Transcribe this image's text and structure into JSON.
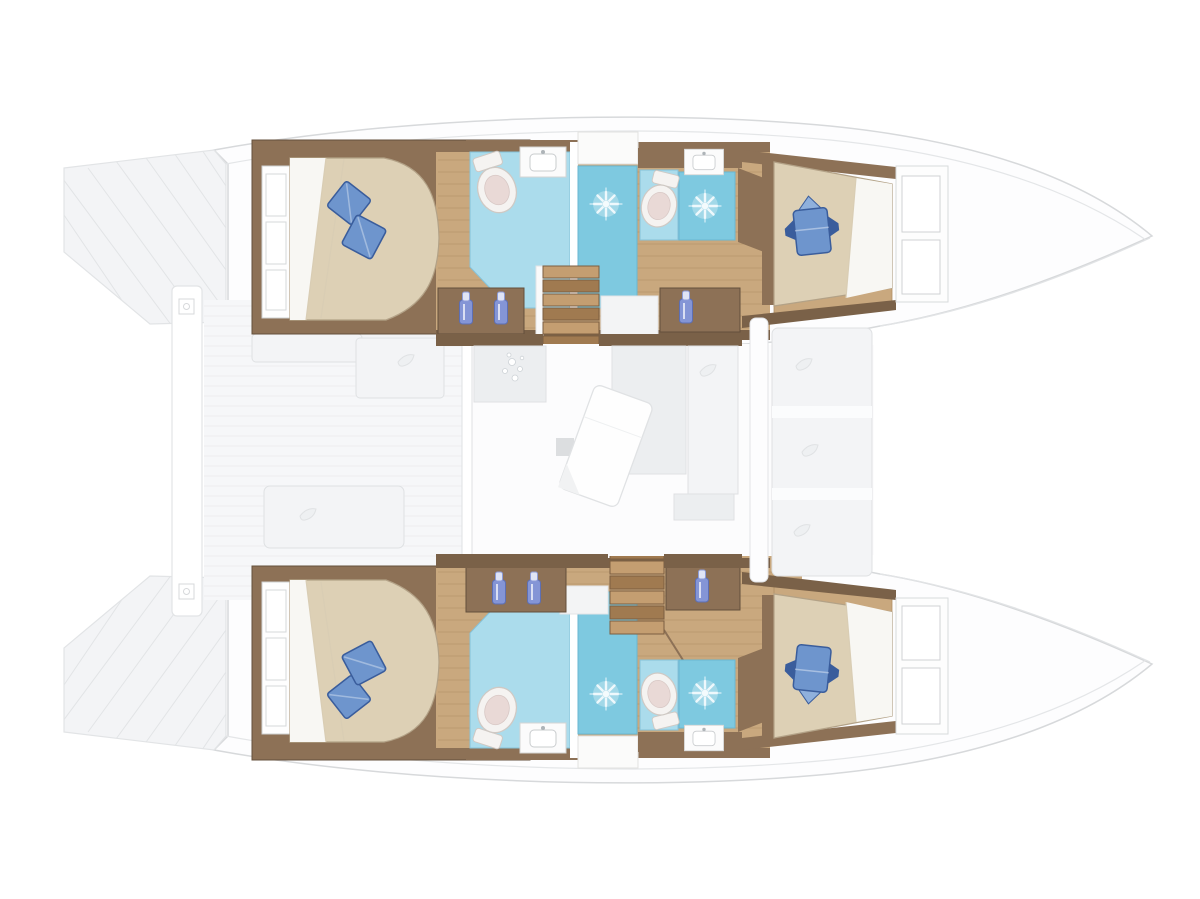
{
  "meta": {
    "description": "Top-down interior layout plan of a sailing catamaran, bows pointing right: two hulls each with an aft double cabin, forward double cabin and two bathroom/shower compartments; central bridgedeck salon with galley counter, tilted dining table and two companionway stairs; aft cockpit deck with benches at left, bow cockpit seating at right.",
    "visible_text": "none"
  },
  "palette": {
    "background": "#ffffff",
    "hull_line": "#d7d9db",
    "hull_line_soft": "#e4e6e8",
    "hull_fill": "#fdfdfe",
    "bridge_fill": "#fcfcfd",
    "deck_fill": "#f6f7f9",
    "deck_line": "#ebedee",
    "transom_fill": "#f3f4f6",
    "transom_line": "#e2e4e6",
    "wall_brown": "#8d7156",
    "wall_brown_dark": "#7a6148",
    "wall_edge": "#64503c",
    "wood_floor": "#c9a87e",
    "wood_line": "#b08f66",
    "bed_beige": "#ddd0b5",
    "bed_edge": "#b3a287",
    "sheet_white": "#f8f7f3",
    "sheet_fold": "#d9cdb4",
    "pillow_blue": "#6e95cd",
    "pillow_blue_dark": "#3a5d9c",
    "pillow_blue_light": "#8fb0dc",
    "bath_blue": "#abdcec",
    "bath_blue_edge": "#86c2d9",
    "shower_blue": "#7ec9e0",
    "shower_edge": "#69b7d2",
    "star_white": "#eef8fc",
    "porcelain": "#f5f3f1",
    "porcelain_line": "#cfc9c4",
    "toilet_pink": "#e9d9d6",
    "counter_white": "#fbfbfb",
    "counter_line": "#d5d5d3",
    "bottle_blue": "#8495d6",
    "bottle_cap": "#dfe4f6",
    "salon_fill": "#eceef0",
    "salon_fill_light": "#f3f4f6",
    "salon_line": "#dfe1e3",
    "stair_light": "#c49e71",
    "stair_dark": "#a07a50",
    "stair_line": "#7c5e41",
    "landing_fill": "#f3f4f5",
    "glass_line": "#e2e4e6"
  },
  "layout": {
    "orientation": "bows-right",
    "hulls": [
      {
        "id": "upper-hull",
        "rooms": [
          "aft-double-cabin",
          "aft-bathroom-with-shower",
          "forward-bathroom-with-shower",
          "forward-double-cabin"
        ]
      },
      {
        "id": "lower-hull",
        "rooms": [
          "aft-double-cabin",
          "aft-bathroom-with-shower",
          "forward-bathroom-with-shower",
          "forward-double-cabin"
        ]
      }
    ],
    "bridgedeck": {
      "salon_features": [
        "galley-counter-with-sink",
        "tilted-dining-table",
        "dinette-sofa",
        "sliding-door-aft"
      ],
      "stairs": [
        "upper-hull-companionway",
        "lower-hull-companionway"
      ]
    },
    "exterior": [
      "aft-cockpit-deck-with-benches",
      "stern-transom-steps",
      "aft-platform-beam",
      "bow-cockpit-seating",
      "port-and-starboard-bow-tips"
    ],
    "counts": {
      "double_cabins": 4,
      "beds": 4,
      "blue_pillows": 6,
      "toilets": 4,
      "shower_cells_with_drain_rosette": 4,
      "sinks": 4,
      "companionway_stairs": 2,
      "counter_bottles": 6,
      "cockpit_benches": 3
    }
  }
}
